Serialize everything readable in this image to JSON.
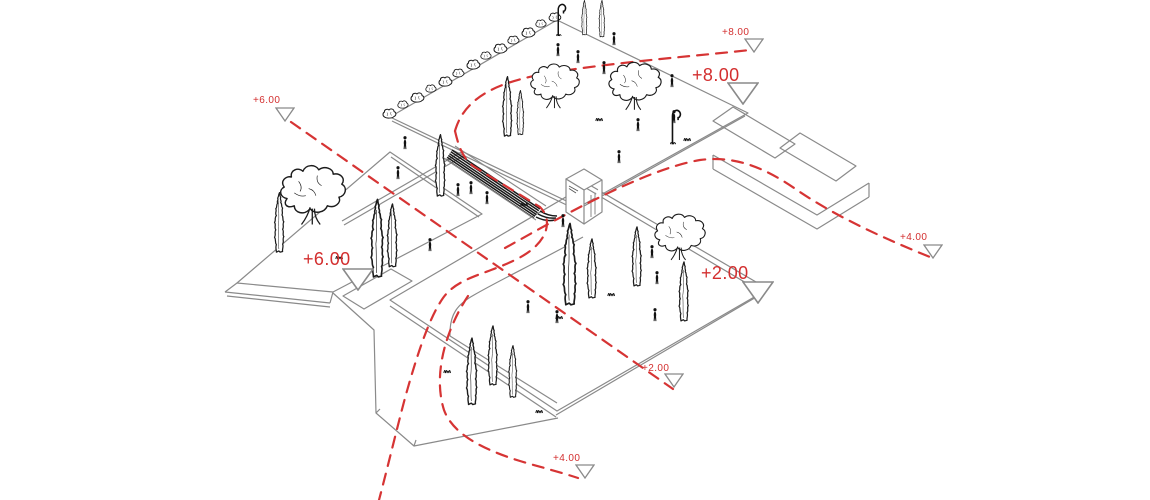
{
  "markers": {
    "big8": {
      "label": "+8.00"
    },
    "big6": {
      "label": "+6.00"
    },
    "big2": {
      "label": "+2.00"
    },
    "small8": {
      "label": "+8.00"
    },
    "small6": {
      "label": "+6.00"
    },
    "small4_right": {
      "label": "+4.00"
    },
    "small2_bottom": {
      "label": "+2.00"
    },
    "small4_bottom": {
      "label": "+4.00"
    }
  },
  "colors": {
    "background": "#ffffff",
    "label_red": "#d32f2f",
    "contour_red": "#d63434",
    "linework_gray": "#8a8a8a",
    "stairs_ink": "#1a1a1a",
    "vegetation_ink": "#1c1c1c"
  },
  "icons": {
    "elevation-triangle": "outlined down-pointing survey triangle (white fill, gray stroke)",
    "cypress-tree": "sketched narrow cypress outline",
    "deciduous-tree": "sketched round-canopy tree with forked trunk",
    "shrub": "small sketched hedge blob",
    "person-figure": "small black staffage silhouette",
    "street-lamp": "curved shepherd-crook lamp post",
    "stairs-ramp": "dark hatched stair/ramp band",
    "contour-path": "red dashed level / route line",
    "grass-tuft": "tiny zigzag grass strokes"
  }
}
